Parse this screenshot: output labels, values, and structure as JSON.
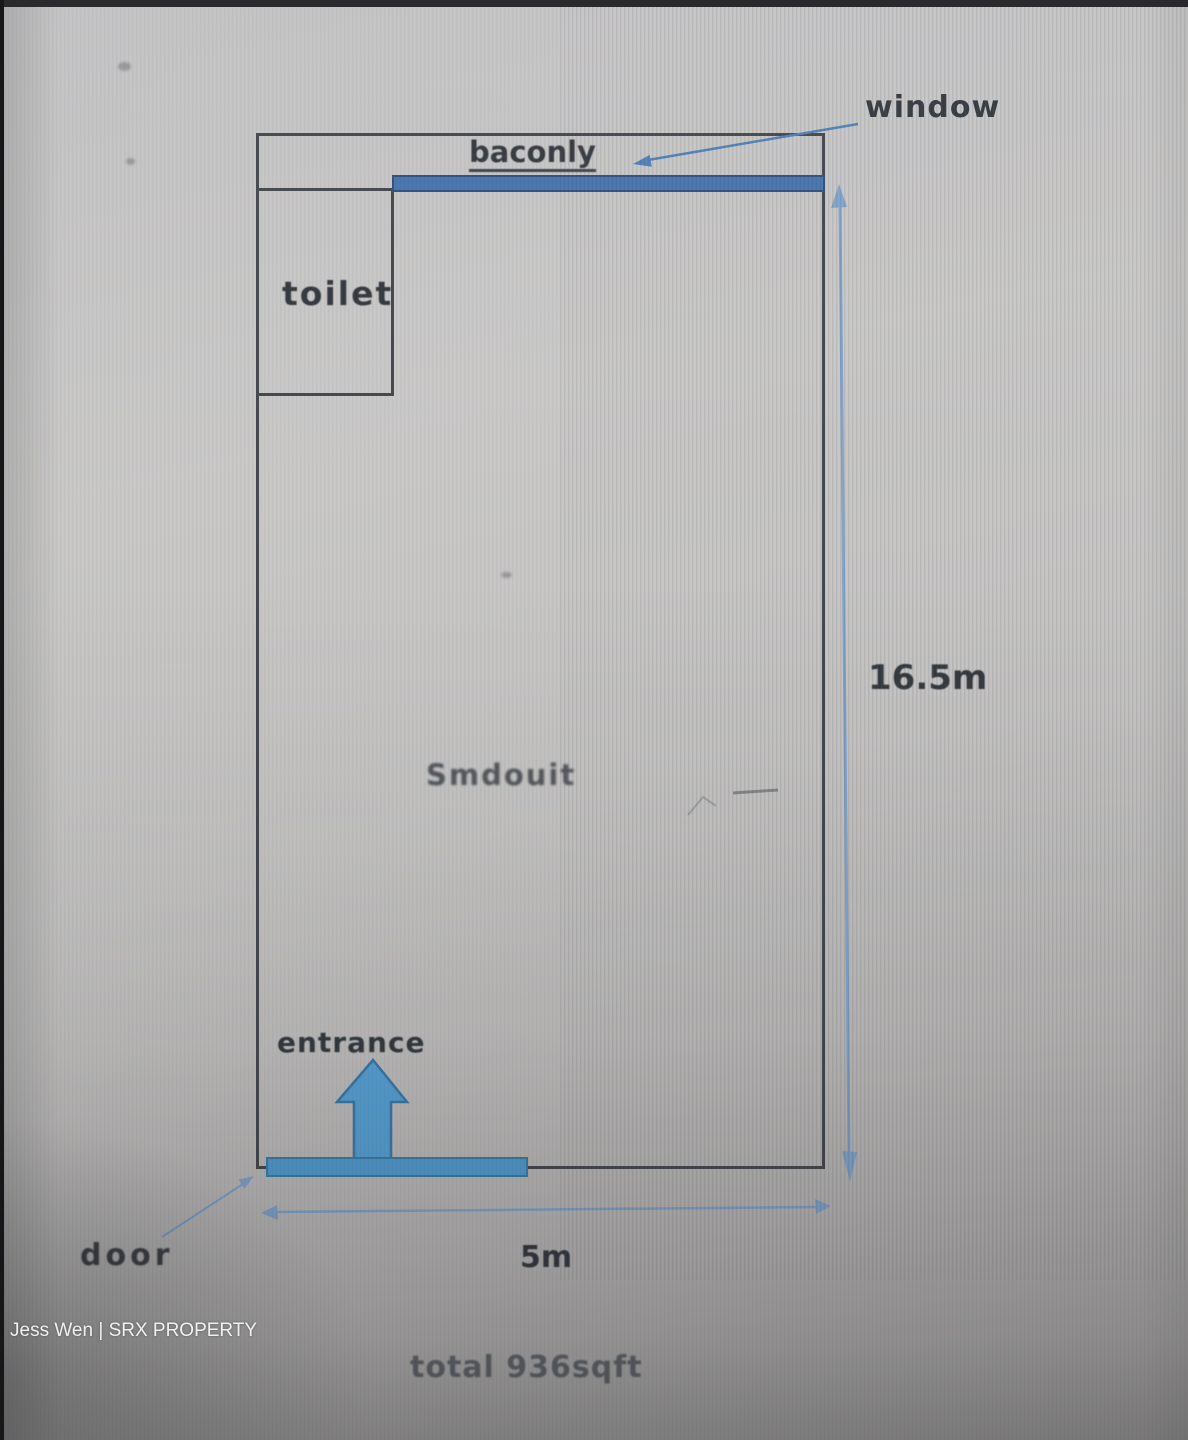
{
  "floorplan": {
    "labels": {
      "window": "window",
      "balcony": "baconly",
      "toilet": "toilet",
      "entrance": "entrance",
      "door": "door",
      "annotation": "Smdouit"
    },
    "dimensions": {
      "height": "16.5m",
      "width": "5m",
      "total_area": "total 936sqft"
    },
    "colors": {
      "wall_line": "#43464b",
      "balcony_bar_fill": "#4573ad",
      "balcony_bar_edge": "#2c4f7e",
      "entrance_arrow_fill": "#55a0d4",
      "entrance_arrow_edge": "#3878a8",
      "threshold_fill": "#4f9ad0",
      "threshold_edge": "#3a7aa8",
      "dimension_arrow": "#7fa3cb",
      "pointer_arrow": "#4d80b8"
    }
  },
  "watermark": {
    "text": "Jess Wen | SRX PROPERTY"
  }
}
